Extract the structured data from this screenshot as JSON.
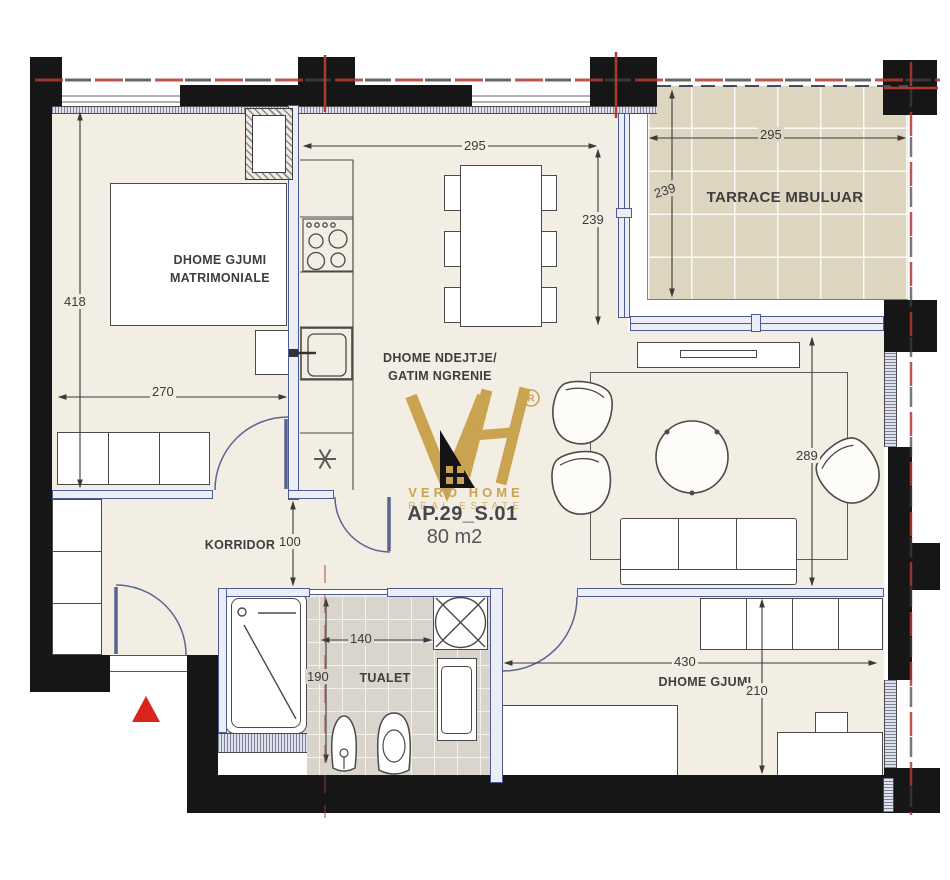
{
  "logo": {
    "monogram": "VH",
    "registered": "®",
    "brand_line1": "VERO HOME",
    "brand_line2": "REAL ESTATE",
    "unit_code": "AP.29_S.01",
    "unit_area": "80 m2"
  },
  "rooms": {
    "master_bedroom": {
      "line1": "DHOME GJUMI",
      "line2": "MATRIMONIALE"
    },
    "living": {
      "line1": "DHOME NDEJTJE/",
      "line2": "GATIM NGRENIE"
    },
    "terrace": {
      "label": "TARRACE MBULUAR"
    },
    "corridor": {
      "label": "KORRIDOR"
    },
    "toilet": {
      "label": "TUALET"
    },
    "bedroom": {
      "label": "DHOME GJUMI"
    }
  },
  "dimensions": {
    "master_height": "418",
    "master_width": "270",
    "dining_width": "295",
    "dining_height": "239",
    "terrace_width": "295",
    "terrace_height": "239",
    "living_height": "289",
    "corridor_width": "100",
    "toilet_width": "140",
    "toilet_height": "190",
    "bedroom_width": "430",
    "bedroom_height": "210"
  },
  "colors": {
    "brand_gold": "#c9a350",
    "axis_red": "#b03a31",
    "wall_black": "#161616",
    "floor": "#f3eee3",
    "terrace_tile": "#ded5c1",
    "toilet_tile": "#d9d5cc",
    "frame_blue": "#4d5a94"
  }
}
